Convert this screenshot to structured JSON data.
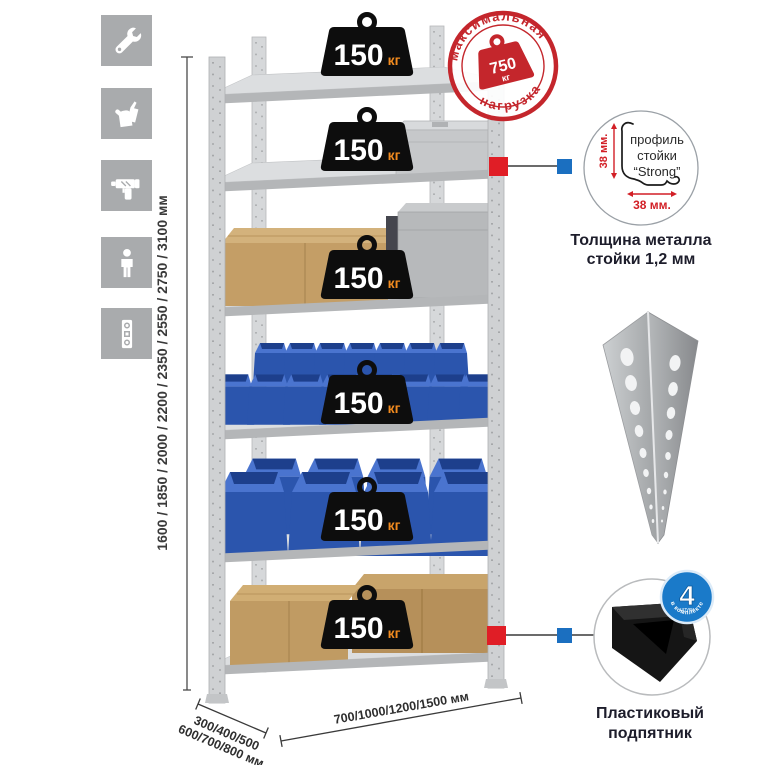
{
  "tools_panel": {
    "icons": [
      {
        "name": "wrench"
      },
      {
        "name": "gloves"
      },
      {
        "name": "drill"
      },
      {
        "name": "person"
      },
      {
        "name": "level"
      }
    ]
  },
  "dimensions": {
    "height": "1600 / 1850 / 2000 / 2200 / 2350 / 2550 / 2750 / 3100 мм",
    "depth_line1": "300/400/500",
    "depth_line2": "600/700/800 мм",
    "width": "700/1000/1200/1500 мм"
  },
  "rack": {
    "shelf_count": 6,
    "loads": [
      {
        "value": "150",
        "unit": "кг"
      },
      {
        "value": "150",
        "unit": "кг"
      },
      {
        "value": "150",
        "unit": "кг"
      },
      {
        "value": "150",
        "unit": "кг"
      },
      {
        "value": "150",
        "unit": "кг"
      },
      {
        "value": "150",
        "unit": "кг"
      }
    ]
  },
  "max_load_stamp": {
    "text_top": "максимальная",
    "text_bottom": "нагрузка",
    "value": "750",
    "unit": "кг"
  },
  "profile_detail": {
    "label_line1": "профиль",
    "label_line2": "стойки",
    "label_line3": "“Strong”",
    "dim_v": "38 мм.",
    "dim_h": "38 мм.",
    "caption1": "Толщина металла",
    "caption2": "стойки 1,2 мм"
  },
  "foot_detail": {
    "badge_number": "4",
    "badge_sub": "штуки",
    "badge_arc": "в комплекте",
    "caption1": "Пластиковый",
    "caption2": "подпятник"
  },
  "colors": {
    "stamp_red": "#c4262c",
    "marker_red": "#e01e26",
    "marker_blue": "#1b6fc0",
    "bin_blue": "#2f5ab5",
    "weight_black": "#0d0d0d",
    "load_unit_orange": "#f28b1f",
    "icon_gray": "#a9abad"
  }
}
